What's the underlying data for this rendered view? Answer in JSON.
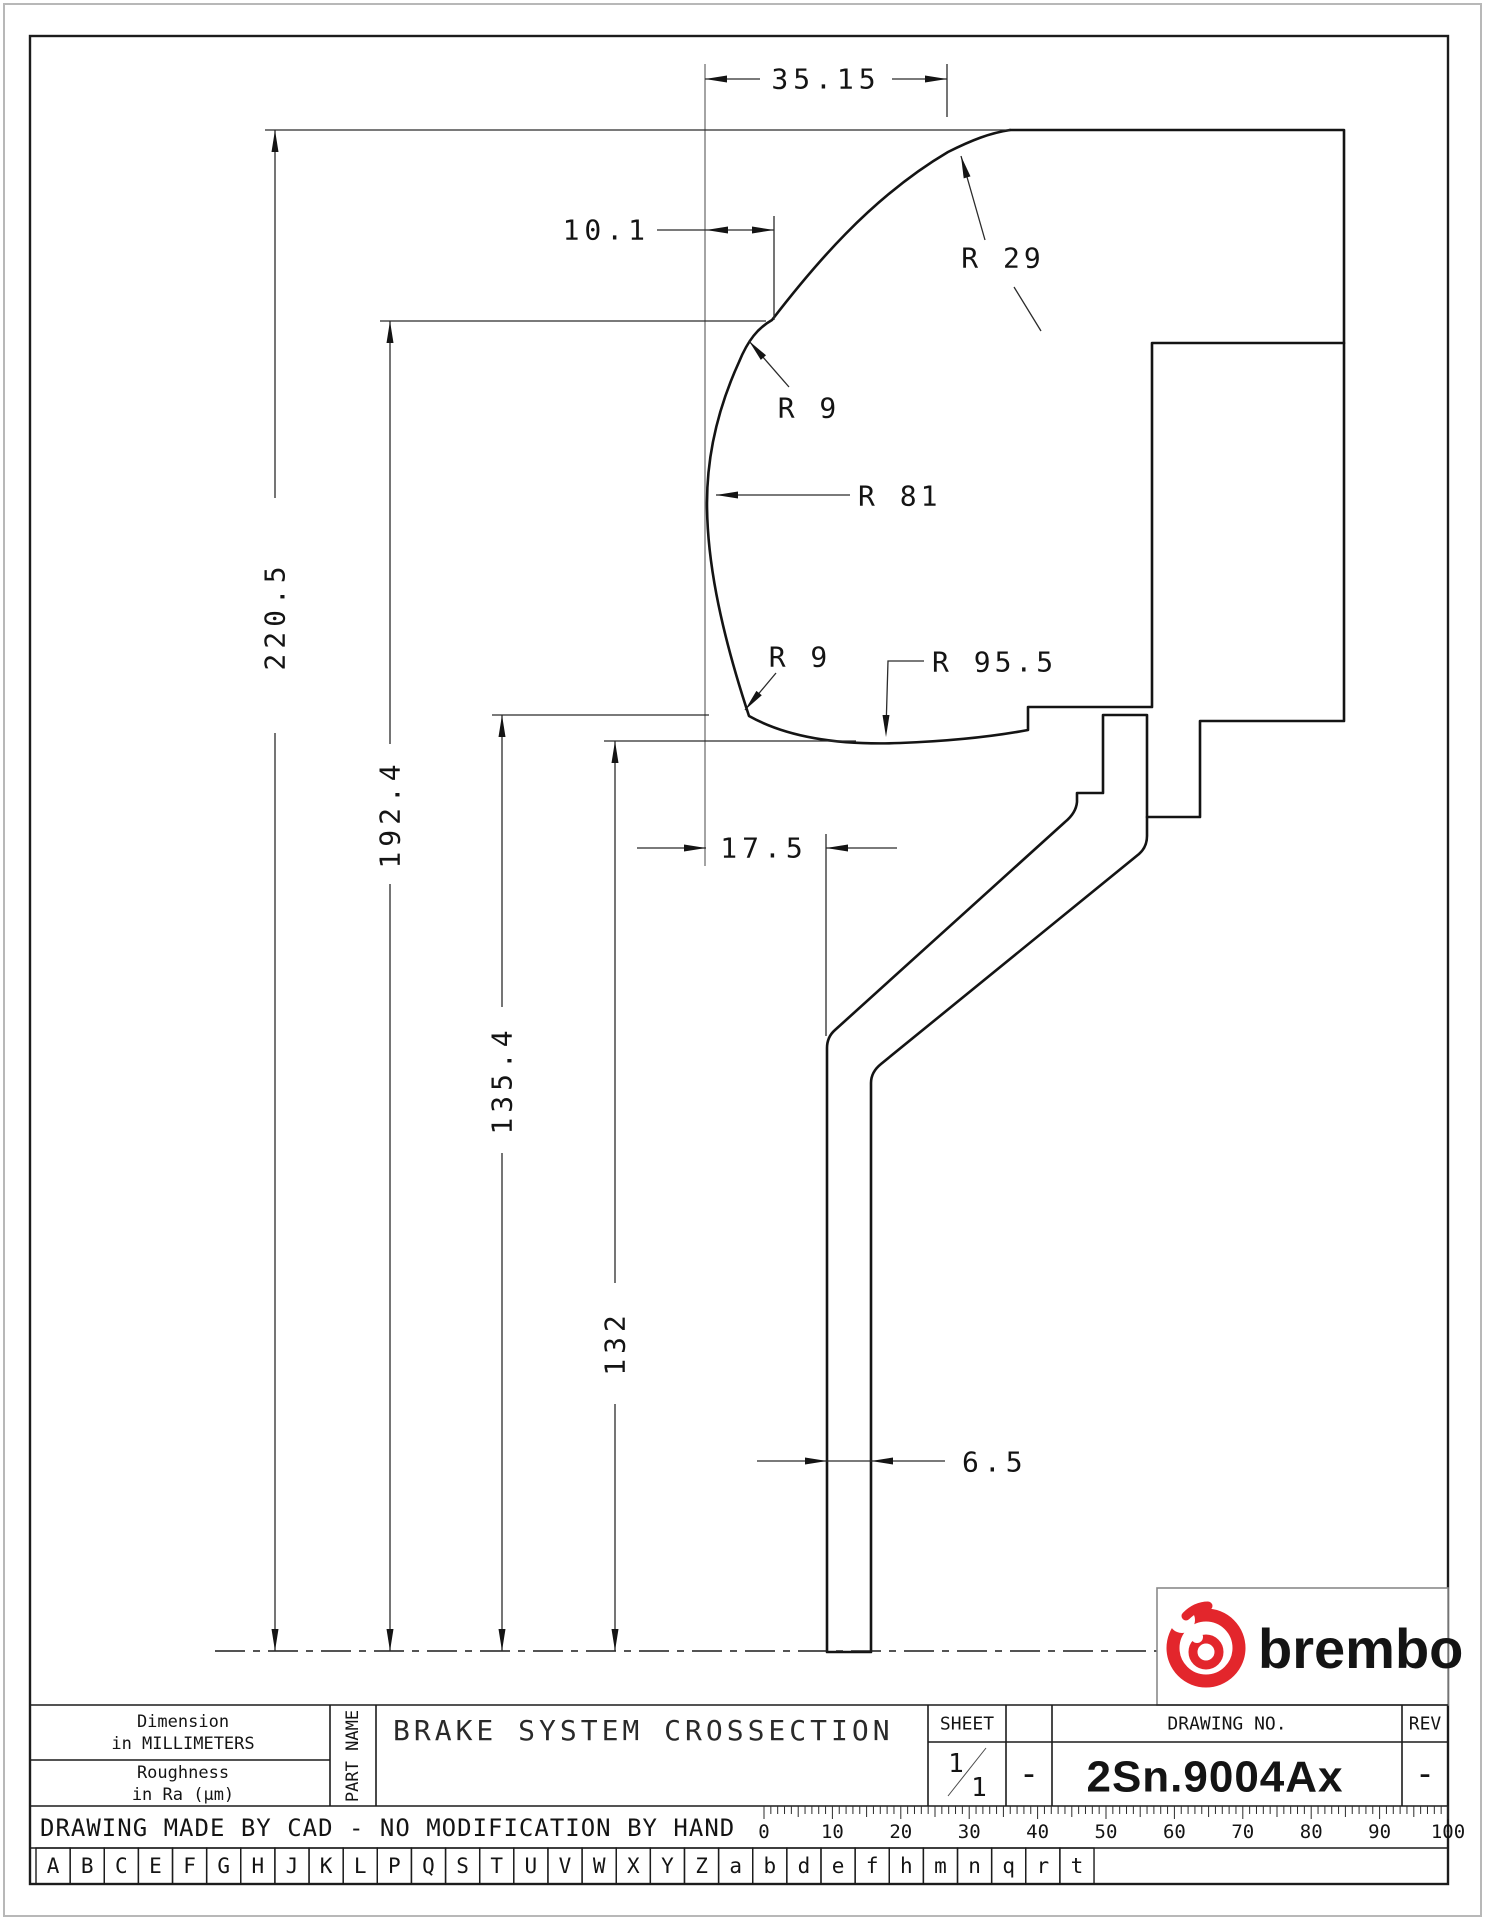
{
  "dims": {
    "top_width": "35.15",
    "notch_offset": "10.1",
    "overall_height": "220.5",
    "notch_height": "192.4",
    "step_height": "135.4",
    "ring_bottom_height": "132",
    "hub_offset": "17.5",
    "plate_thickness": "6.5",
    "radius_top": "R 29",
    "radius_notch": "R 9",
    "radius_face": "R 81",
    "radius_lower_fillet": "R 9",
    "radius_bottom": "R 95.5"
  },
  "title_block": {
    "dimension_note_line1": "Dimension",
    "dimension_note_line2": "in MILLIMETERS",
    "roughness_note_line1": "Roughness",
    "roughness_note_line2": "in Ra (μm)",
    "part_name_label": "PART NAME",
    "part_title": "BRAKE SYSTEM CROSSECTION",
    "sheet_label": "SHEET",
    "sheet_numerator": "1",
    "sheet_denominator": "1",
    "sheet_dash": "-",
    "drawing_no_label": "DRAWING NO.",
    "drawing_no_value": "2Sn.9004Ax",
    "rev_label": "REV",
    "rev_value": "-",
    "cad_note": "DRAWING MADE BY CAD - NO MODIFICATION BY HAND"
  },
  "logo": {
    "text": "brembo",
    "color": "#e3262c"
  },
  "ruler": {
    "labels": [
      "0",
      "10",
      "20",
      "30",
      "40",
      "50",
      "60",
      "70",
      "80",
      "90",
      "100"
    ]
  },
  "reference_letters": [
    "A",
    "B",
    "C",
    "E",
    "F",
    "G",
    "H",
    "J",
    "K",
    "L",
    "P",
    "Q",
    "S",
    "T",
    "U",
    "V",
    "W",
    "X",
    "Y",
    "Z",
    "a",
    "b",
    "d",
    "e",
    "f",
    "h",
    "m",
    "n",
    "q",
    "r",
    "t"
  ]
}
